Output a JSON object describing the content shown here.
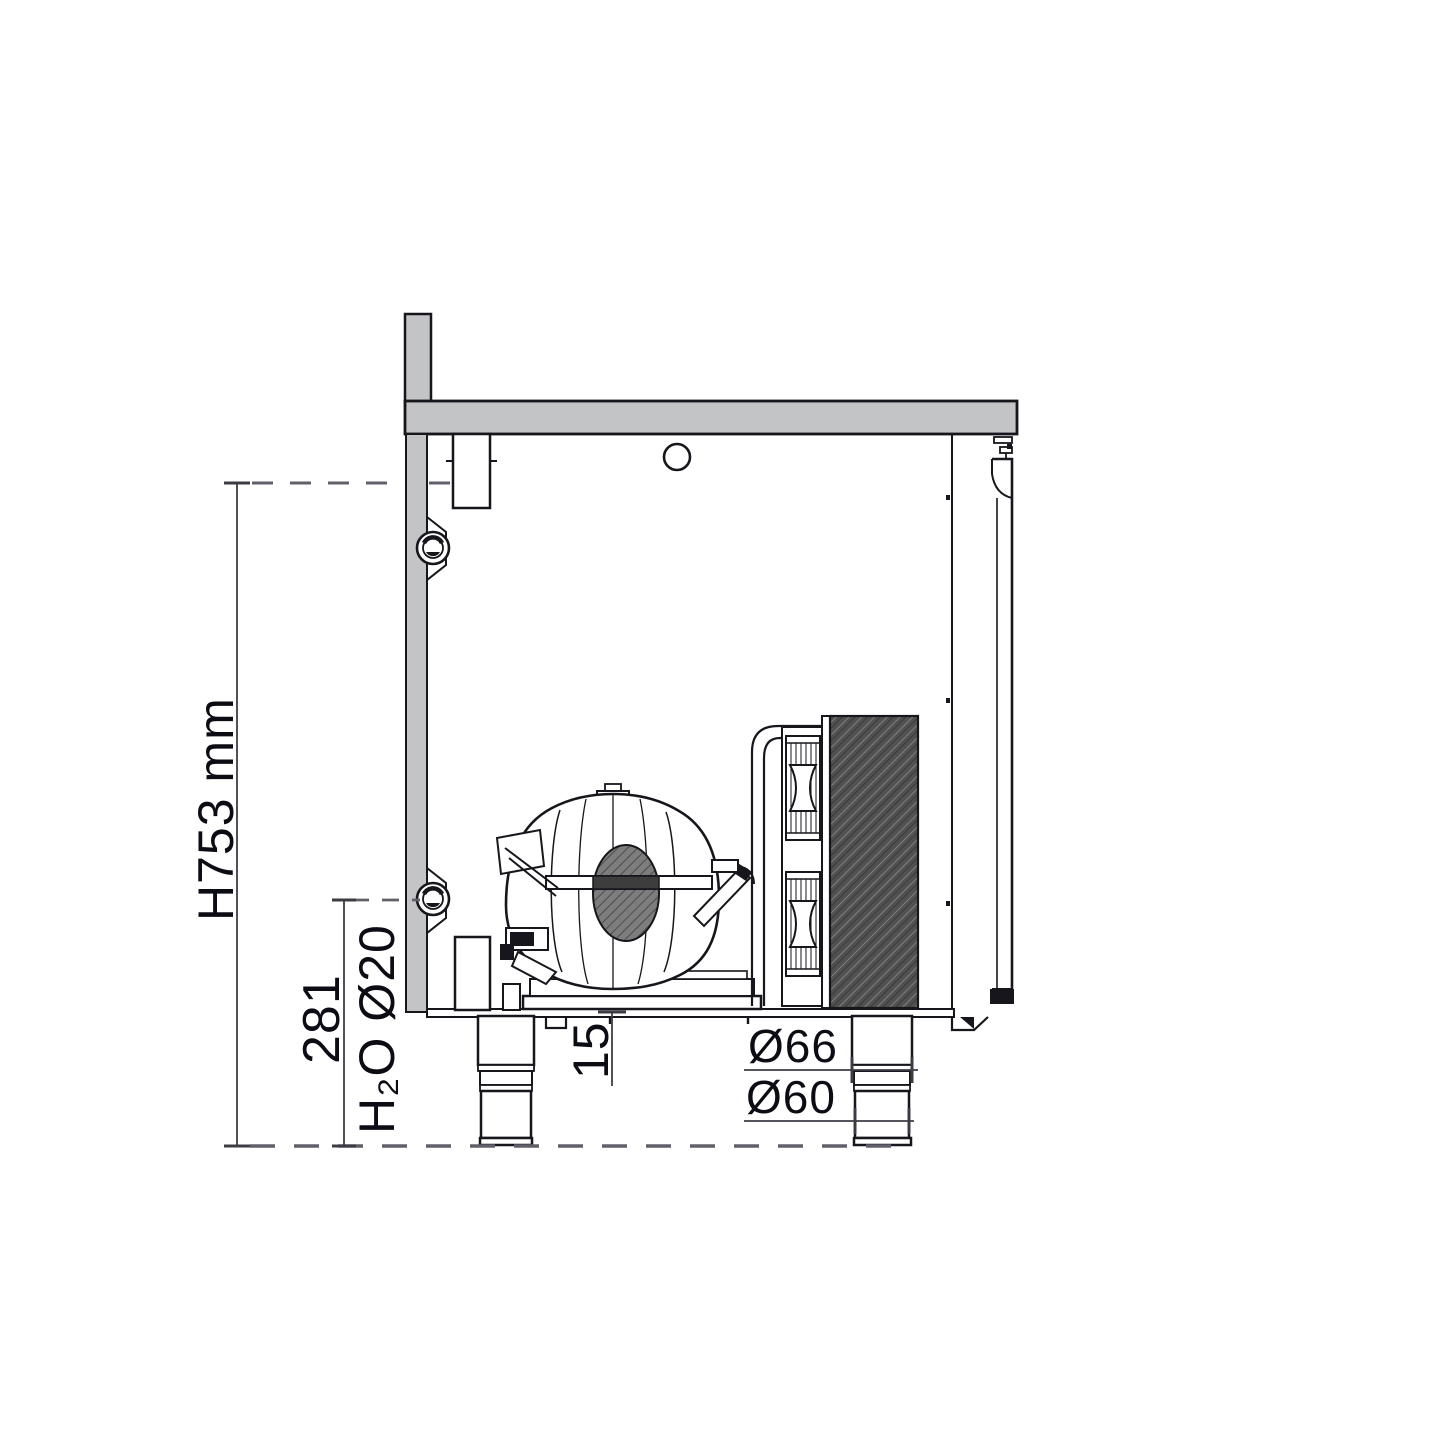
{
  "drawing": {
    "title": "refrigerated-counter-side-section",
    "labels": {
      "overall_height": "H753 mm",
      "drain_height": "281",
      "water_drain": "H₂O Ø20",
      "base_offset": "15",
      "leg_upper_diameter": "Ø66",
      "leg_lower_diameter": "Ø60"
    },
    "colors": {
      "line": "#16161c",
      "panel_gray": "#c3c4c6",
      "dimension_line": "#3c3c44",
      "dashed_line": "#60606a",
      "text": "#0c0c14",
      "condenser_hatch_bg": "#515151",
      "condenser_hatch_line": "#949494",
      "background": "#ffffff"
    }
  }
}
